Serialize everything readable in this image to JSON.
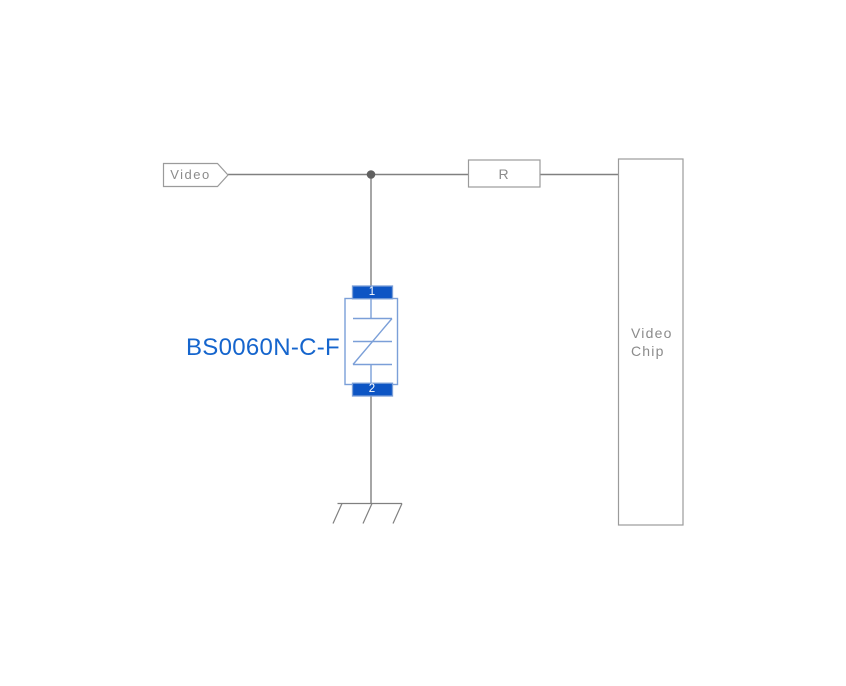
{
  "colors": {
    "background": "#ffffff",
    "wire": "#808080",
    "box_border": "#9b9b9b",
    "box_fill": "#ffffff",
    "text_gray": "#8b8b8b",
    "junction": "#606060",
    "pad_fill": "#0d55c4",
    "component_outline": "#7b9fd8",
    "part_label_blue": "#1565cd",
    "pin_text": "#ffffff"
  },
  "schematic": {
    "net_flag": {
      "label": "Video"
    },
    "resistor": {
      "label": "R"
    },
    "chip": {
      "label": "Video\nChip"
    },
    "tvs_component": {
      "part_number": "BS0060N-C-F",
      "pin1": "1",
      "pin2": "2"
    },
    "icons": {
      "junction": "junction-dot",
      "ground": "ground-symbol",
      "net_flag_shape": "net-flag-pentagon",
      "tvs_symbol": "bidirectional-suppressor-symbol"
    }
  }
}
